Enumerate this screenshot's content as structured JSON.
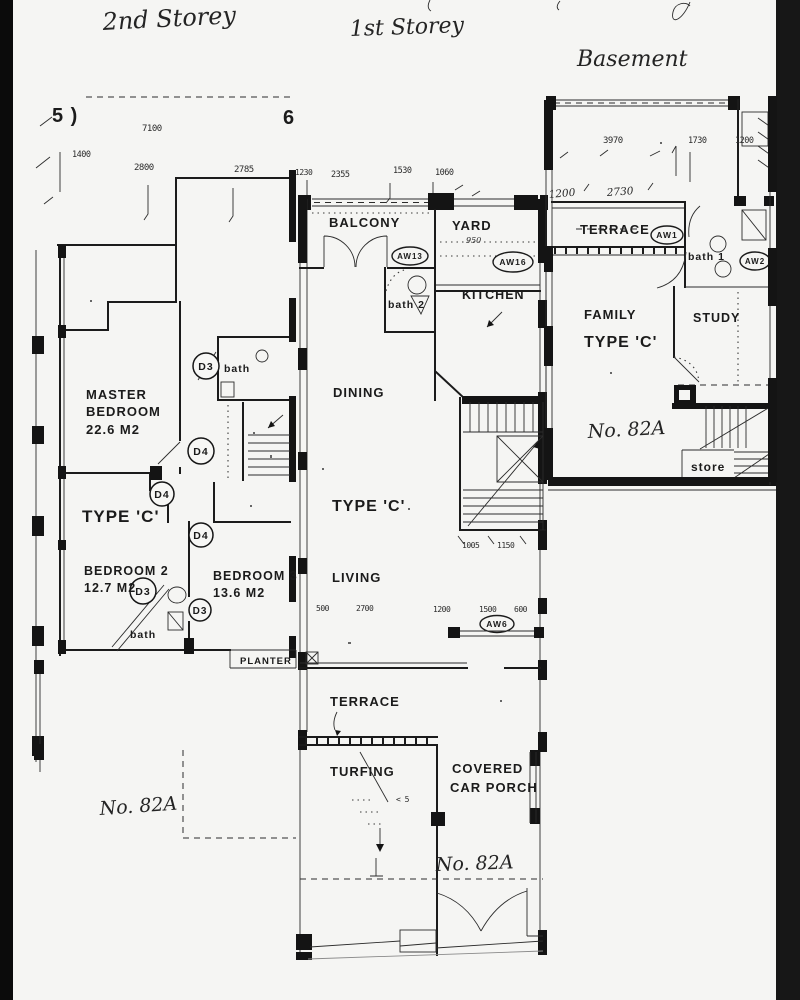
{
  "colors": {
    "paper": "#f5f5f3",
    "ink": "#1b1b1b",
    "edge": "#0e0e0e"
  },
  "titles": {
    "second": "2nd Storey",
    "first": "1st Storey",
    "basement": "Basement"
  },
  "second_storey": {
    "marker_left": "5 )",
    "marker_right": "6",
    "dim_7100": "7100",
    "dim_1400": "1400",
    "dim_2800": "2800",
    "dim_2785": "2785",
    "master_1": "MASTER",
    "master_2": "BEDROOM",
    "master_area": "22.6 M2",
    "type_c": "TYPE 'C'",
    "bedroom2": "BEDROOM 2",
    "bedroom2_area": "12.7 M2",
    "bedroom3": "BEDROOM 3",
    "bedroom3_area": "13.6 M2",
    "d3": "D3",
    "d4": "D4",
    "bath": "bath",
    "planter": "PLANTER",
    "house_no": "No. 82A"
  },
  "first_storey": {
    "dims_top": [
      "1230",
      "2355",
      "1530",
      "1060"
    ],
    "balcony": "BALCONY",
    "yard": "YARD",
    "yard_dim": "950",
    "kitchen": "KITCHEN",
    "bath2": "bath 2",
    "aw13": "AW13",
    "aw16": "AW16",
    "dining": "DINING",
    "type_c": "TYPE 'C'",
    "dim_1005": "1005",
    "dim_1150": "1150",
    "living": "LIVING",
    "dims_mid": [
      "500",
      "2700",
      "1200",
      "1500",
      "600"
    ],
    "aw6": "AW6",
    "terrace": "TERRACE",
    "turfing": "TURFING",
    "turfing_note": "< 5",
    "carporch_1": "COVERED",
    "carporch_2": "CAR PORCH",
    "house_no": "No. 82A"
  },
  "basement": {
    "dim_3970": "3970",
    "dim_1730": "1730",
    "dim_1200": "1200",
    "hand_1200": "1200",
    "hand_2730": "2730",
    "terrace": "TERRACE",
    "aw1": "AW1",
    "aw2": "AW2",
    "bath1": "bath 1",
    "family": "FAMILY",
    "type_c": "TYPE 'C'",
    "study": "STUDY",
    "store": "store",
    "house_no": "No. 82A"
  }
}
